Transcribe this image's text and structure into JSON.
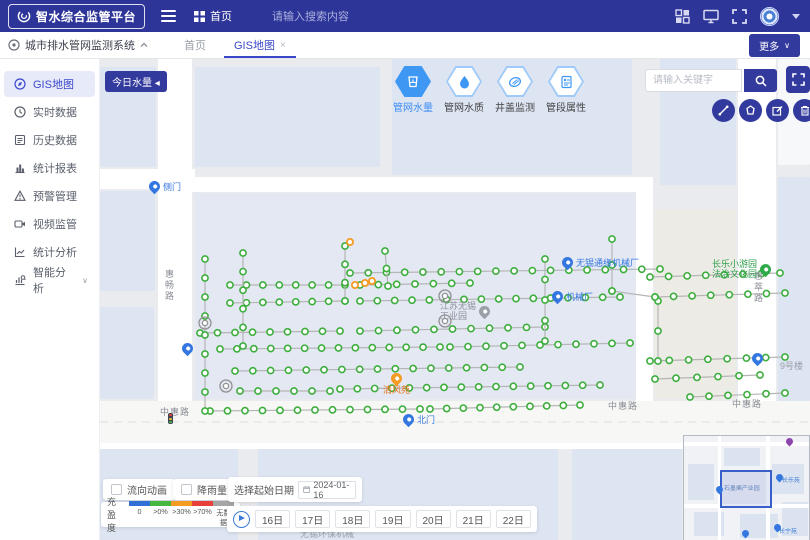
{
  "header": {
    "logo_text": "智水综合监管平台",
    "home_label": "首页",
    "search_placeholder": "请输入搜索内容"
  },
  "tab_bar": {
    "system_label": "城市排水管网监测系统",
    "tabs": [
      {
        "label": "首页",
        "active": false
      },
      {
        "label": "GIS地图",
        "active": true,
        "close": "×"
      }
    ],
    "more_label": "更多"
  },
  "sidebar": {
    "items": [
      {
        "label": "GIS地图",
        "icon": "gis-map-icon",
        "active": true
      },
      {
        "label": "实时数据",
        "icon": "clock-icon"
      },
      {
        "label": "历史数据",
        "icon": "history-icon"
      },
      {
        "label": "统计报表",
        "icon": "bar-chart-icon"
      },
      {
        "label": "预警管理",
        "icon": "alert-icon"
      },
      {
        "label": "视频监管",
        "icon": "video-icon"
      },
      {
        "label": "统计分析",
        "icon": "trend-icon"
      },
      {
        "label": "智能分析",
        "icon": "smart-analysis-icon",
        "expandable": true
      }
    ]
  },
  "map_toolbar": {
    "today_button": "今日水量 ◂",
    "layers": [
      {
        "label": "管网水量",
        "icon": "water-volume-icon",
        "active": true
      },
      {
        "label": "管网水质",
        "icon": "water-quality-icon",
        "active": false
      },
      {
        "label": "井盖监测",
        "icon": "manhole-icon",
        "active": false
      },
      {
        "label": "管段属性",
        "icon": "pipe-attribute-icon",
        "active": false
      }
    ],
    "search_placeholder": "请输入关键字"
  },
  "bottom_panel": {
    "toggles": [
      {
        "label": "流向动画",
        "checked": false
      },
      {
        "label": "降雨量",
        "checked": false
      }
    ],
    "legend": {
      "title": "充盈度",
      "items": [
        {
          "label": "0",
          "color": "#2f6fd6"
        },
        {
          "label": ">0%",
          "color": "#46b842"
        },
        {
          "label": ">30%",
          "color": "#f59a23"
        },
        {
          "label": ">70%",
          "color": "#e8413c"
        },
        {
          "label": "无数据",
          "color": "#a6a6a6"
        }
      ]
    },
    "date_picker": {
      "label": "选择起始日期",
      "value": "2024-01-16"
    },
    "days": [
      "16日",
      "17日",
      "18日",
      "19日",
      "20日",
      "21日",
      "22日"
    ]
  },
  "map_scene": {
    "colors": {
      "base": "#e9ebee",
      "block": "#dde4f2",
      "block_warm": "#ecebe5",
      "road": "#ffffff",
      "pipe": "#b5b5b5",
      "marker_green": "#3dae3d",
      "marker_orange": "#f59a23",
      "marker_gray": "#909090"
    },
    "blocks": [
      {
        "x": 0,
        "y": 8,
        "w": 56,
        "h": 100
      },
      {
        "x": 0,
        "y": 132,
        "w": 55,
        "h": 100
      },
      {
        "x": 0,
        "y": 248,
        "w": 54,
        "h": 92
      },
      {
        "x": 95,
        "y": 8,
        "w": 185,
        "h": 100
      },
      {
        "x": 292,
        "y": 0,
        "w": 240,
        "h": 116
      },
      {
        "x": 560,
        "y": 0,
        "w": 76,
        "h": 126
      },
      {
        "x": 678,
        "y": 0,
        "w": 32,
        "h": 106,
        "c": "#f7f8fa"
      },
      {
        "x": 678,
        "y": 118,
        "w": 32,
        "h": 224
      },
      {
        "x": 95,
        "y": 134,
        "w": 441,
        "h": 206,
        "c": "#e3e8f3"
      },
      {
        "x": 554,
        "y": 150,
        "w": 82,
        "h": 190,
        "c": "#ecebe5"
      },
      {
        "x": 0,
        "y": 390,
        "w": 138,
        "h": 92
      },
      {
        "x": 158,
        "y": 390,
        "w": 300,
        "h": 92
      },
      {
        "x": 472,
        "y": 390,
        "w": 110,
        "h": 92
      }
    ],
    "roads": [
      {
        "x": 58,
        "y": 0,
        "w": 34,
        "h": 382
      },
      {
        "x": 0,
        "y": 110,
        "w": 95,
        "h": 20
      },
      {
        "x": 92,
        "y": 118,
        "w": 446,
        "h": 15
      },
      {
        "x": 536,
        "y": 118,
        "w": 17,
        "h": 264
      },
      {
        "x": 638,
        "y": 0,
        "w": 38,
        "h": 382
      },
      {
        "x": 0,
        "y": 342,
        "w": 710,
        "h": 42,
        "c": "#f7f7f5"
      },
      {
        "x": 0,
        "y": 384,
        "w": 710,
        "h": 6
      }
    ],
    "pipes": [
      {
        "x1": 250,
        "y1": 214,
        "x2": 560,
        "y2": 210,
        "n": 18
      },
      {
        "x1": 130,
        "y1": 226,
        "x2": 245,
        "y2": 226,
        "n": 8
      },
      {
        "x1": 260,
        "y1": 226,
        "x2": 370,
        "y2": 224,
        "n": 7
      },
      {
        "x1": 130,
        "y1": 244,
        "x2": 245,
        "y2": 242,
        "n": 8
      },
      {
        "x1": 260,
        "y1": 242,
        "x2": 520,
        "y2": 238,
        "n": 16
      },
      {
        "x1": 100,
        "y1": 274,
        "x2": 240,
        "y2": 272,
        "n": 9
      },
      {
        "x1": 260,
        "y1": 272,
        "x2": 445,
        "y2": 268,
        "n": 11
      },
      {
        "x1": 120,
        "y1": 290,
        "x2": 340,
        "y2": 288,
        "n": 14
      },
      {
        "x1": 350,
        "y1": 288,
        "x2": 530,
        "y2": 284,
        "n": 11
      },
      {
        "x1": 135,
        "y1": 312,
        "x2": 420,
        "y2": 308,
        "n": 17
      },
      {
        "x1": 140,
        "y1": 332,
        "x2": 230,
        "y2": 332,
        "n": 6
      },
      {
        "x1": 240,
        "y1": 330,
        "x2": 500,
        "y2": 326,
        "n": 16
      },
      {
        "x1": 110,
        "y1": 352,
        "x2": 320,
        "y2": 350,
        "n": 13
      },
      {
        "x1": 330,
        "y1": 350,
        "x2": 480,
        "y2": 346,
        "n": 10
      },
      {
        "x1": 105,
        "y1": 200,
        "x2": 105,
        "y2": 352,
        "n": 9
      },
      {
        "x1": 143,
        "y1": 194,
        "x2": 143,
        "y2": 287,
        "n": 6
      },
      {
        "x1": 245,
        "y1": 187,
        "x2": 245,
        "y2": 242,
        "n": 4
      },
      {
        "x1": 445,
        "y1": 200,
        "x2": 445,
        "y2": 282,
        "n": 5
      },
      {
        "x1": 512,
        "y1": 180,
        "x2": 512,
        "y2": 232,
        "n": 3
      },
      {
        "x1": 550,
        "y1": 218,
        "x2": 680,
        "y2": 214,
        "n": 8
      },
      {
        "x1": 555,
        "y1": 238,
        "x2": 685,
        "y2": 234,
        "n": 8
      },
      {
        "x1": 550,
        "y1": 302,
        "x2": 685,
        "y2": 298,
        "n": 8
      },
      {
        "x1": 555,
        "y1": 320,
        "x2": 660,
        "y2": 316,
        "n": 6
      },
      {
        "x1": 590,
        "y1": 338,
        "x2": 685,
        "y2": 334,
        "n": 6
      },
      {
        "x1": 558,
        "y1": 242,
        "x2": 558,
        "y2": 302,
        "n": 3
      },
      {
        "x1": 512,
        "y1": 232,
        "x2": 555,
        "y2": 238,
        "n": 2
      },
      {
        "x1": 285,
        "y1": 192,
        "x2": 288,
        "y2": 227,
        "n": 3
      }
    ],
    "special_markers": [
      {
        "x": 265,
        "y": 224,
        "type": "orange"
      },
      {
        "x": 272,
        "y": 222,
        "type": "orange"
      },
      {
        "x": 255,
        "y": 226,
        "type": "orange"
      },
      {
        "x": 250,
        "y": 183,
        "type": "orange"
      },
      {
        "x": 345,
        "y": 237,
        "type": "gray-big"
      },
      {
        "x": 345,
        "y": 262,
        "type": "gray-big"
      },
      {
        "x": 105,
        "y": 264,
        "type": "gray-big"
      },
      {
        "x": 126,
        "y": 327,
        "type": "gray-big"
      }
    ],
    "labels": [
      {
        "t": "road",
        "text": "中惠路",
        "x": 60,
        "y": 346
      },
      {
        "t": "road",
        "text": "中惠路",
        "x": 508,
        "y": 340
      },
      {
        "t": "road",
        "text": "中惠路",
        "x": 632,
        "y": 338
      },
      {
        "t": "road-v",
        "text": "惠畅路",
        "x": 63,
        "y": 210
      },
      {
        "t": "road-v",
        "text": "惠萃路",
        "x": 652,
        "y": 212
      },
      {
        "t": "pin-blue",
        "text": "侧门",
        "x": 49,
        "y": 122
      },
      {
        "t": "pin-blue",
        "text": "北门",
        "x": 303,
        "y": 355
      },
      {
        "t": "pin-blue",
        "text": "无锡通缘机械厂",
        "x": 462,
        "y": 198
      },
      {
        "t": "pin-blue",
        "text": "机械厂",
        "x": 452,
        "y": 232
      },
      {
        "t": "pin-blue",
        "text": "",
        "x": 82,
        "y": 284
      },
      {
        "t": "pin-blue",
        "text": "",
        "x": 652,
        "y": 294
      },
      {
        "t": "pin-green left",
        "text": "长乐小游园\n法治文化园",
        "x": 612,
        "y": 200
      },
      {
        "t": "pin-gray left",
        "text": "江苏无锡\n工业园",
        "x": 340,
        "y": 242
      },
      {
        "t": "pin-orange below",
        "text": "清风苑",
        "x": 283,
        "y": 314
      },
      {
        "t": "gray-text",
        "text": "9号楼",
        "x": 680,
        "y": 300
      },
      {
        "t": "gray-text",
        "text": "无锡环保机械",
        "x": 200,
        "y": 468
      },
      {
        "t": "traffic",
        "text": "",
        "x": 68,
        "y": 354
      }
    ]
  },
  "minimap": {
    "labels": [
      {
        "text": "石墨烯产业园",
        "x": 40,
        "y": 48,
        "c": "#5b7fb9"
      },
      {
        "text": "长乐苑",
        "x": 98,
        "y": 40,
        "c": "#3a7bd5"
      },
      {
        "text": "长宁苑",
        "x": 95,
        "y": 91,
        "c": "#3a7bd5"
      }
    ],
    "pins": [
      {
        "x": 32,
        "y": 50,
        "c": "blue"
      },
      {
        "x": 92,
        "y": 38,
        "c": "blue"
      },
      {
        "x": 90,
        "y": 88,
        "c": "blue"
      },
      {
        "x": 58,
        "y": 94,
        "c": "blue"
      },
      {
        "x": 102,
        "y": 2,
        "c": "purple"
      }
    ]
  }
}
